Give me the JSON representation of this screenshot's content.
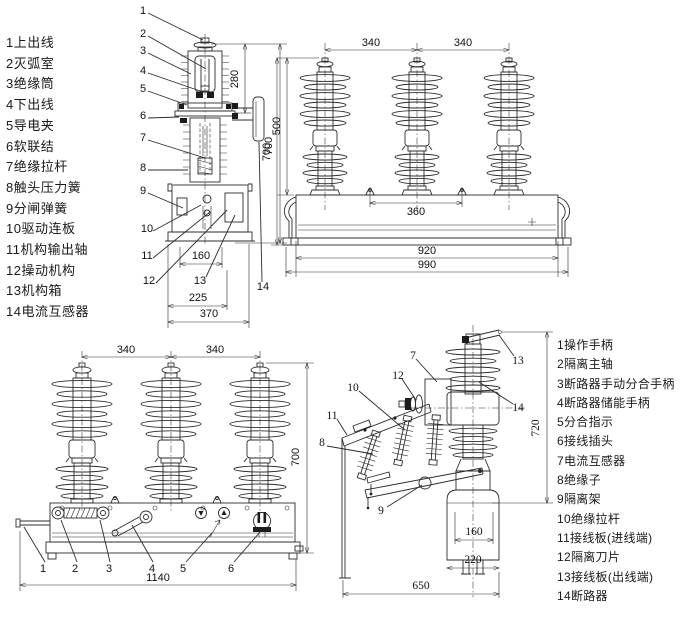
{
  "colors": {
    "line": "#2c2c2c",
    "text": "#1a1a1a",
    "background": "#ffffff"
  },
  "left_list": {
    "items": [
      "1上出线",
      "2灭弧室",
      "3绝缘筒",
      "4下出线",
      "5导电夹",
      "6软联结",
      "7绝缘拉杆",
      "8触头压力簧",
      "9分闸弹簧",
      "10驱动连板",
      "11机构输出轴",
      "12操动机构",
      "13机构箱",
      "14电流互感器"
    ]
  },
  "right_list": {
    "items": [
      "1操作手柄",
      "2隔离主轴",
      "3断路器手动分合手柄",
      "4断路器储能手柄",
      "5分合指示",
      "6接线插头",
      "7电流互感器",
      "8绝缘子",
      "9隔离架",
      "10绝缘拉杆",
      "11接线板(进线端)",
      "12隔离刀片",
      "13接线板(出线端)",
      "14断路器"
    ]
  },
  "top_side_view": {
    "callouts": {
      "c1": "1",
      "c2": "2",
      "c3": "3",
      "c4": "4",
      "c5": "5",
      "c6": "6",
      "c7": "7",
      "c8": "8",
      "c9": "9",
      "c10": "10",
      "c11": "11",
      "c12": "12",
      "c13": "13",
      "c14": "14"
    },
    "dims": {
      "h280": "280",
      "h700": "700",
      "w160": "160",
      "w225": "225",
      "w370": "370"
    }
  },
  "top_front_view": {
    "dims": {
      "s340a": "340",
      "s340b": "340",
      "h500": "500",
      "h700": "700",
      "w360": "360",
      "w920": "920",
      "w990": "990"
    }
  },
  "bottom_front_view": {
    "callouts": {
      "c1": "1",
      "c2": "2",
      "c3": "3",
      "c4": "4",
      "c5": "5",
      "c6": "6"
    },
    "dims": {
      "s340a": "340",
      "s340b": "340",
      "h700": "700",
      "w1140": "1140"
    }
  },
  "bottom_side_view": {
    "callouts": {
      "c7": "7",
      "c8": "8",
      "c9": "9",
      "c10": "10",
      "c11": "11",
      "c12": "12",
      "c13": "13",
      "c14": "14"
    },
    "dims": {
      "h720": "720",
      "w160": "160",
      "w220": "220",
      "w650": "650"
    }
  }
}
